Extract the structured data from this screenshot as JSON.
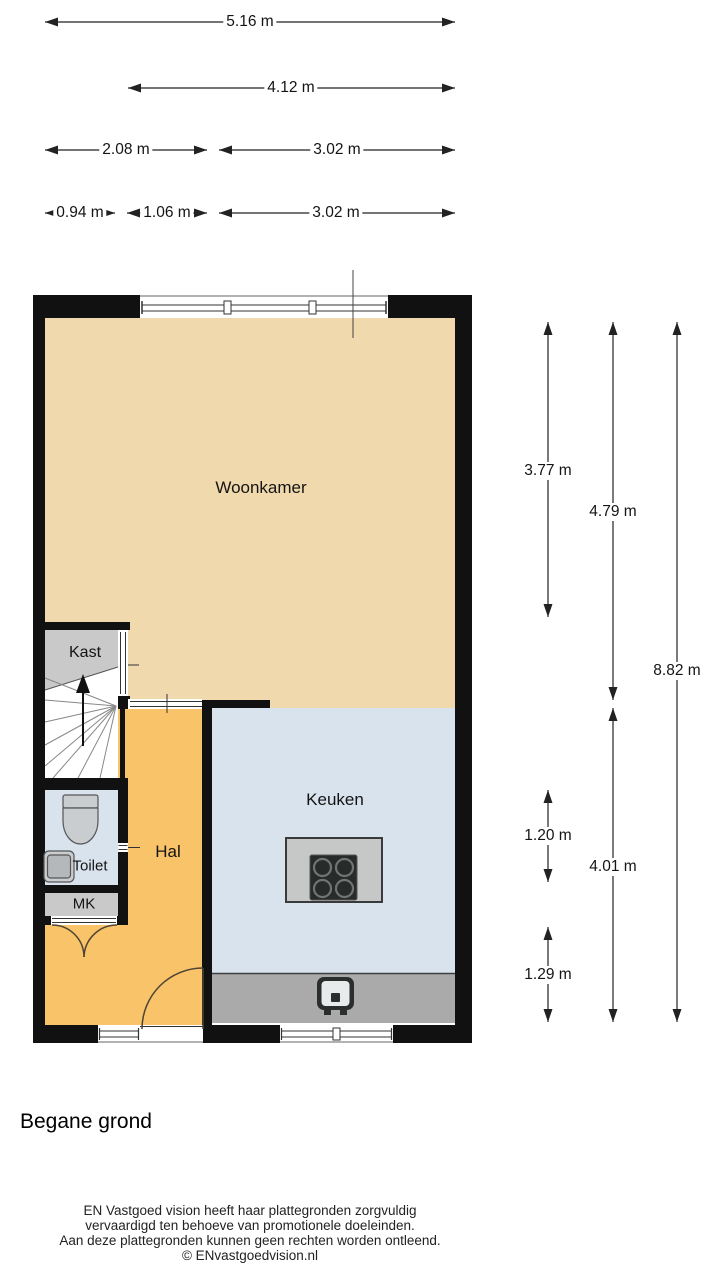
{
  "floor": {
    "title": "Begane grond"
  },
  "rooms": {
    "woonkamer": "Woonkamer",
    "kast": "Kast",
    "hal": "Hal",
    "toilet": "Toilet",
    "mk": "MK",
    "keuken": "Keuken"
  },
  "dimensions": {
    "width_total": "5.16 m",
    "width_woonkamer": "4.12 m",
    "width_left_zone": "2.08 m",
    "width_right_zone": "3.02 m",
    "width_kast": "0.94 m",
    "width_hal": "1.06 m",
    "width_keuken": "3.02 m",
    "height_woonkamer": "3.77 m",
    "height_left": "4.79 m",
    "height_total": "8.82 m",
    "height_toilet": "1.20 m",
    "height_keuken": "4.01 m",
    "height_hal": "1.29 m"
  },
  "footer": {
    "line1": "EN Vastgoed vision heeft haar plattegronden zorgvuldig",
    "line2": "vervaardigd ten behoeve van promotionele doeleinden.",
    "line3": "Aan deze plattegronden kunnen geen rechten worden ontleend.",
    "copyright": "© ENvastgoedvision.nl"
  },
  "colors": {
    "wall": "#111111",
    "woonkamer": "#f1d9ae",
    "hal": "#f9c369",
    "keuken": "#d9e3ee",
    "toilet": "#d9e3ee",
    "kast": "#c9c9c9",
    "mk": "#c9c9c9",
    "counter": "#a9aaa9",
    "island": "#c6c8c8",
    "stove": "#272b2a",
    "fixture": "#c9cdd0"
  }
}
